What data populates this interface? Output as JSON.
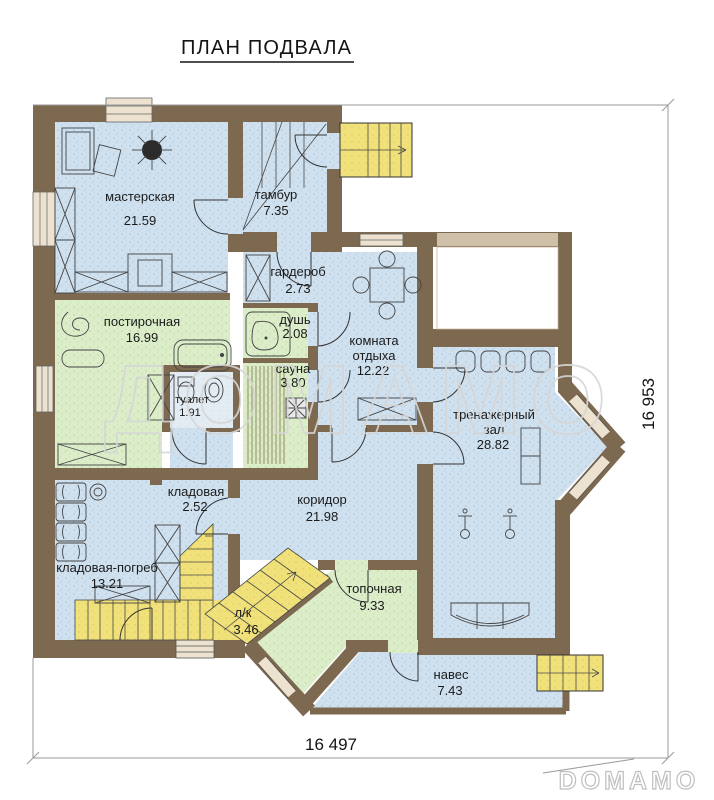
{
  "title": "ПЛАН ПОДВАЛА",
  "watermark": "ДОМАМО",
  "logo": "DOMAMO",
  "dimensions": {
    "width_label": "16 497",
    "height_label": "16 953"
  },
  "rooms": {
    "masterskaya": {
      "name": "мастерская",
      "area": "21.59"
    },
    "tambur": {
      "name": "тамбур",
      "area": "7.35"
    },
    "garderob": {
      "name": "гардероб",
      "area": "2.73"
    },
    "dush": {
      "name": "душь",
      "area": "2.08"
    },
    "sauna": {
      "name": "сауна",
      "area": "3.80"
    },
    "tualet": {
      "name": "туалет",
      "area": "1.91"
    },
    "postirochnaya": {
      "name": "постирочная",
      "area": "16.99"
    },
    "komnata_otdyha": {
      "line1": "комната",
      "line2": "отдыха",
      "area": "12.22"
    },
    "trenazherny_zal": {
      "line1": "тренажерный",
      "line2": "зал",
      "area": "28.82"
    },
    "kladovaya": {
      "name": "кладовая",
      "area": "2.52"
    },
    "kladovaya_pogreb": {
      "name": "кладовая-погреб",
      "area": "13.21"
    },
    "lk": {
      "name": "л/к",
      "area": "3.46"
    },
    "koridor": {
      "name": "коридор",
      "area": "21.98"
    },
    "topochnaya": {
      "name": "топочная",
      "area": "9.33"
    },
    "naves": {
      "name": "навес",
      "area": "7.43"
    }
  },
  "colors": {
    "wall": "#7c6950",
    "floor_blue": "#cfe0ee",
    "floor_green": "#dcedca",
    "floor_yellow": "#f0e17a",
    "floor_pale": "#e3ecf3",
    "window": "#ece2cf",
    "dimension_line": "#999999",
    "text": "#1b1b1b",
    "watermark": "#d6d6d6"
  }
}
